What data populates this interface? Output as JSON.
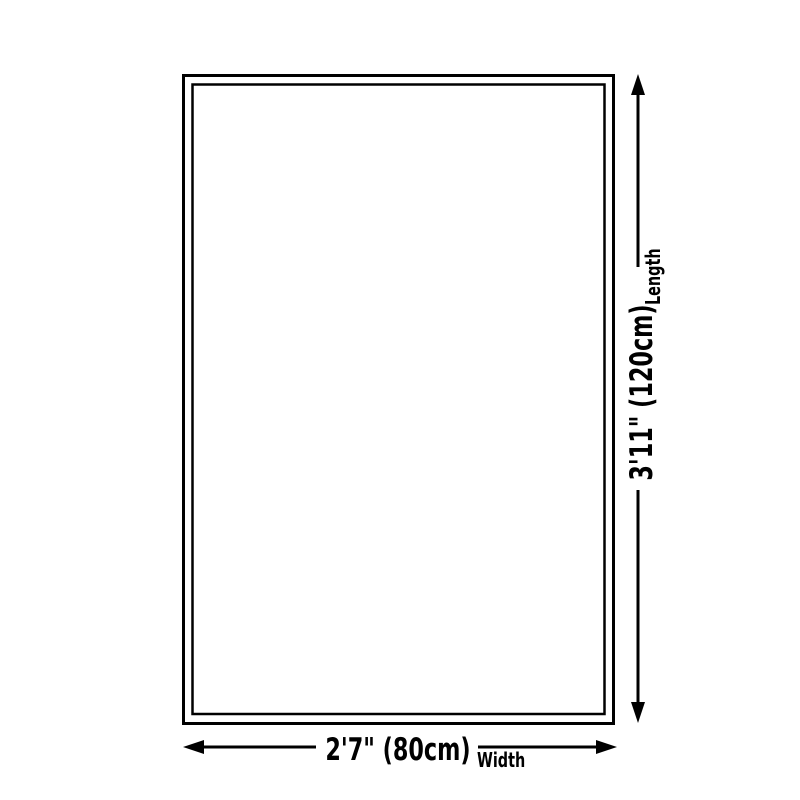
{
  "diagram": {
    "length": {
      "value": "3'11\" (120cm)",
      "axis_label": "Length"
    },
    "width": {
      "value": "2'7\" (80cm)",
      "axis_label": "Width"
    },
    "icons": {
      "vertical_dimension": "arrow-up-down",
      "horizontal_dimension": "arrow-left-right"
    },
    "colors": {
      "line": "#000000",
      "background": "#ffffff"
    }
  }
}
